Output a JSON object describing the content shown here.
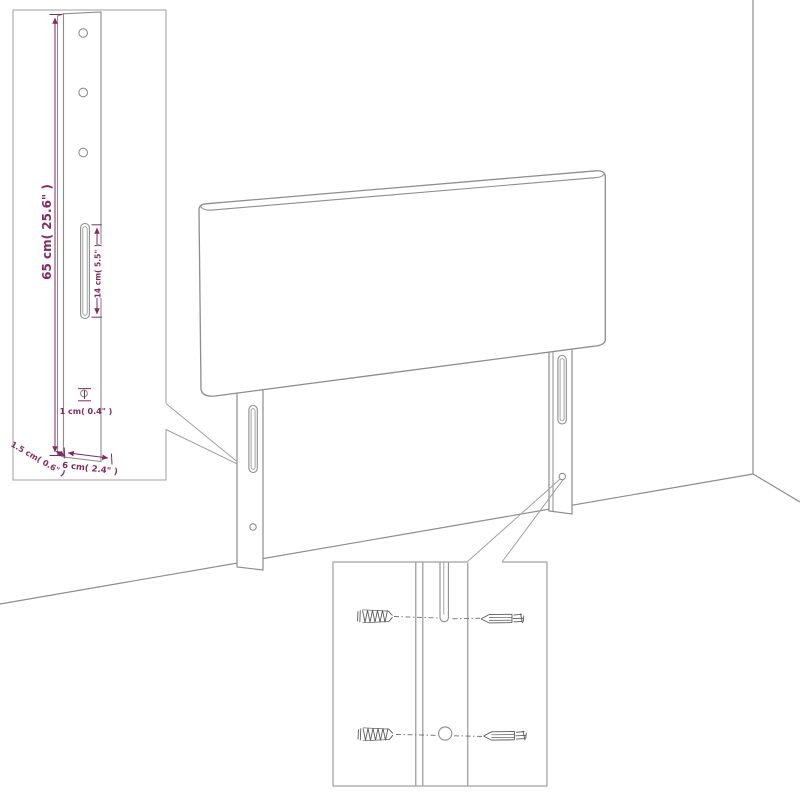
{
  "colors": {
    "line": "#8d8d8d",
    "inset_border": "#9f9f9f",
    "dimension_accent": "#822b60",
    "screw": "#5a5a5a",
    "background": "#ffffff"
  },
  "diagram": {
    "dimensions": {
      "leg_height": "65 cm( 25.6\" )",
      "slot_length": "14 cm( 5.5\" )",
      "hole_diameter": "1 cm( 0.4\" )",
      "leg_thickness": "1.5 cm( 0.6\" )",
      "leg_width": "6 cm( 2.4\" )"
    }
  }
}
